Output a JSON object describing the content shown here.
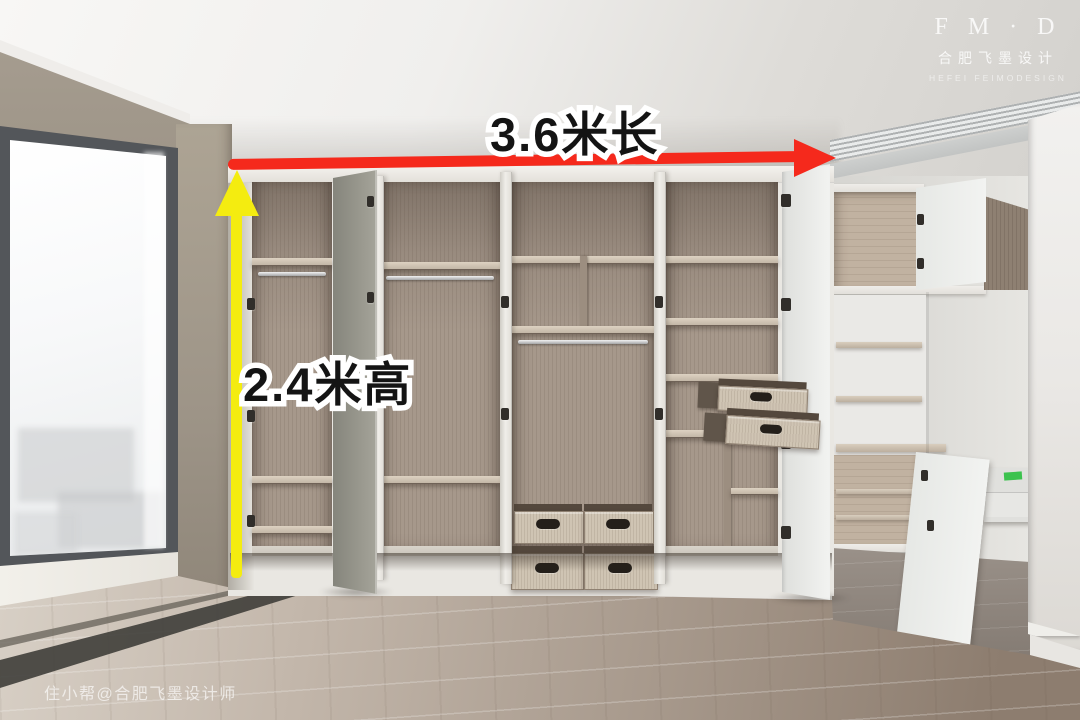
{
  "annotations": {
    "width_label": "3.6米长",
    "height_label": "2.4米高"
  },
  "watermark": {
    "brand_initials": "F M · D",
    "brand_name_cn": "合肥飞墨设计",
    "brand_name_en": "HEFEI FEIMODESIGN",
    "credit": "住小帮@合肥飞墨设计师"
  },
  "colors": {
    "arrow-red": "#f5291c",
    "arrow-yellow": "#f4ec10",
    "label-fill": "#141414",
    "label-stroke": "#ffffff"
  }
}
